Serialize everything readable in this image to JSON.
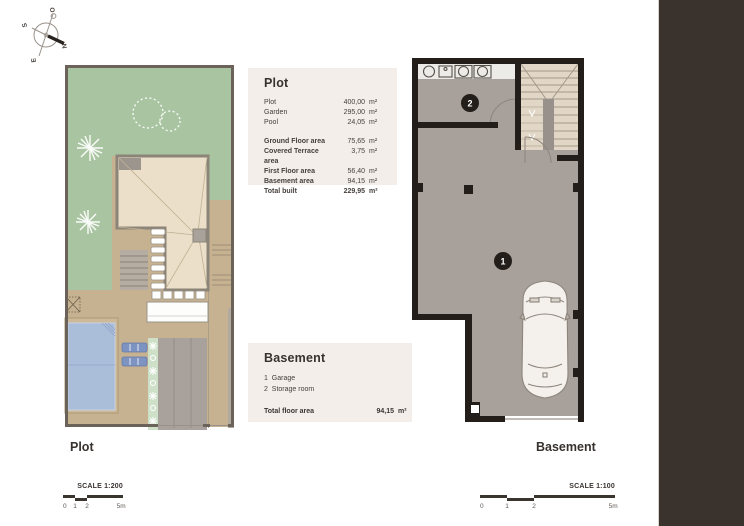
{
  "document": {
    "captions": {
      "plot": "Plot",
      "basement": "Basement"
    },
    "scale_left": {
      "text": "SCALE 1:200",
      "ticks": [
        "0",
        "1",
        "2",
        "5m"
      ]
    },
    "scale_right": {
      "text": "SCALE 1:100",
      "ticks": [
        "0",
        "1",
        "2",
        "5m"
      ]
    }
  },
  "compass": {
    "north": "N",
    "south": "S",
    "east": "E",
    "west": "O"
  },
  "plot_info": {
    "title": "Plot",
    "rows_group1": [
      {
        "label": "Plot",
        "value": "400,00",
        "unit": "m²"
      },
      {
        "label": "Garden",
        "value": "295,00",
        "unit": "m²"
      },
      {
        "label": "Pool",
        "value": "24,05",
        "unit": "m²"
      }
    ],
    "rows_group2": [
      {
        "label": "Ground Floor area",
        "value": "75,65",
        "unit": "m²"
      },
      {
        "label": "Covered Terrace area",
        "value": "3,75",
        "unit": "m²"
      },
      {
        "label": "First Floor area",
        "value": "56,40",
        "unit": "m²"
      },
      {
        "label": "Basement area",
        "value": "94,15",
        "unit": "m²"
      },
      {
        "label": "Total built",
        "value": "229,95",
        "unit": "m²"
      }
    ]
  },
  "basement_info": {
    "title": "Basement",
    "items": [
      {
        "num": "1",
        "label": "Garage"
      },
      {
        "num": "2",
        "label": "Storage room"
      }
    ],
    "total_label": "Total floor area",
    "total_value": "94,15",
    "total_unit": "m²"
  },
  "basement_plan": {
    "badge_garage": "1",
    "badge_storage": "2"
  },
  "colors": {
    "side_strip": "#3a332d",
    "infobox_bg": "#f3eeea",
    "wall_dark": "#231e1a",
    "floor_grey": "#a7a09b",
    "stairs_beige": "#e2d7c6",
    "garden_green": "#a9c4a0",
    "hardscape_tan": "#c6b190",
    "roof_beige": "#ecdfc9",
    "pool_blue": "#aabdd9",
    "lounger_blue": "#7d94c2",
    "planting_green": "#cfe0c8",
    "driveway_grey": "#a9a29c",
    "plot_border": "#6b6359"
  }
}
